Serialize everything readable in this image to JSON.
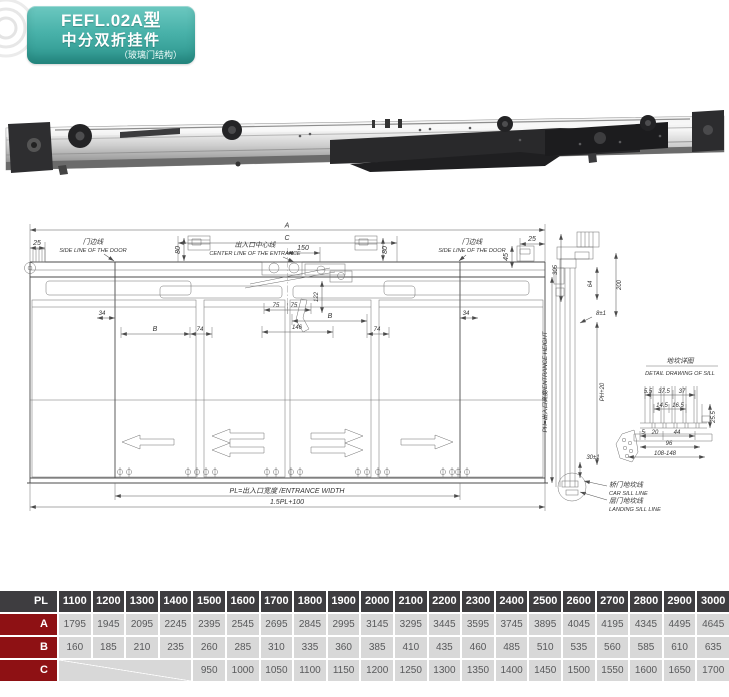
{
  "header": {
    "model": "FEFL.02A型",
    "name": "中分双折挂件",
    "structure": "（玻璃门结构）"
  },
  "drawing": {
    "front": {
      "label_a": "A",
      "label_c": "C",
      "dim_150": "150",
      "dim_80": "80",
      "dim_25": "25",
      "dim_45": "45",
      "dim_34": "34",
      "label_b": "B",
      "dim_74": "74",
      "dim_75": "75",
      "dim_146": "146",
      "dim_122": "122",
      "door_side_line_cn": "门边线",
      "door_side_line_en": "SIDE LINE OF THE DOOR",
      "center_line_cn": "出入口中心线",
      "center_line_en": "CENTER LINE OF THE ENTRANCE",
      "entrance_width": "PL=出入口宽度 /ENTRANCE WIDTH",
      "overall_width": "1.5PL+100"
    },
    "side": {
      "dim_305": "305",
      "dim_200": "200",
      "dim_64": "64",
      "dim_8": "8±1",
      "dim_ph20": "PH+20",
      "dim_30": "30±1",
      "entrance_height": "PH=出入口高度/ENTRANCE  HEIGHT",
      "car_sill_cn": "轿门地坎线",
      "car_sill_en": "CAR SILL LINE",
      "landing_sill_cn": "层门地坎线",
      "landing_sill_en": "LANDING SILL LINE"
    },
    "sill": {
      "title_cn": "地坎详图",
      "title_en": "DETAIL DRAWING OF SILL",
      "dim_5_5": "5.5",
      "dim_37_5": "37.5",
      "dim_37": "37",
      "dim_14_5": "14.5",
      "dim_16_5": "16.5",
      "dim_25_5": "25.5",
      "dim_5": "5",
      "dim_20": "20",
      "dim_44": "44",
      "dim_96": "96",
      "dim_range": "108-148"
    }
  },
  "table": {
    "header_label": "PL",
    "columns": [
      "1100",
      "1200",
      "1300",
      "1400",
      "1500",
      "1600",
      "1700",
      "1800",
      "1900",
      "2000",
      "2100",
      "2200",
      "2300",
      "2400",
      "2500",
      "2600",
      "2700",
      "2800",
      "2900",
      "3000"
    ],
    "rows": [
      {
        "label": "A",
        "empty_span": 0,
        "values": [
          "1795",
          "1945",
          "2095",
          "2245",
          "2395",
          "2545",
          "2695",
          "2845",
          "2995",
          "3145",
          "3295",
          "3445",
          "3595",
          "3745",
          "3895",
          "4045",
          "4195",
          "4345",
          "4495",
          "4645"
        ]
      },
      {
        "label": "B",
        "empty_span": 0,
        "values": [
          "160",
          "185",
          "210",
          "235",
          "260",
          "285",
          "310",
          "335",
          "360",
          "385",
          "410",
          "435",
          "460",
          "485",
          "510",
          "535",
          "560",
          "585",
          "610",
          "635"
        ]
      },
      {
        "label": "C",
        "empty_span": 4,
        "values": [
          "950",
          "1000",
          "1050",
          "1100",
          "1150",
          "1200",
          "1250",
          "1300",
          "1350",
          "1400",
          "1450",
          "1500",
          "1550",
          "1600",
          "1650",
          "1700"
        ]
      }
    ]
  },
  "colors": {
    "accent_teal": "#3aa79f",
    "table_header_bg": "#3e3d40",
    "table_label_bg": "#8e1114",
    "table_cell_bg": "#d8d8d8",
    "table_cell_text": "#58595b"
  }
}
